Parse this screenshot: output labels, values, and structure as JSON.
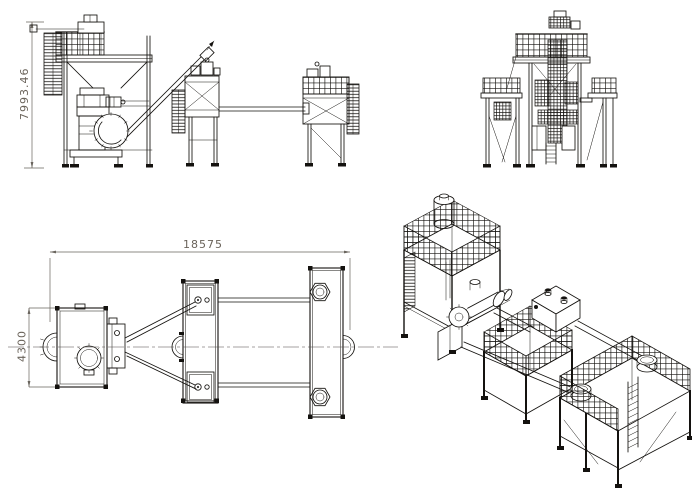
{
  "drawing": {
    "dimensions": {
      "overall_height": {
        "value": "7993.46",
        "orientation": "vertical",
        "view": "front-elevation"
      },
      "overall_length": {
        "value": "18575",
        "orientation": "horizontal",
        "view": "plan"
      },
      "overall_width": {
        "value": "4300",
        "orientation": "vertical",
        "view": "plan"
      }
    },
    "colors": {
      "background": "#ffffff",
      "line": "#14120f",
      "dimension_text": "#6a635a",
      "dimension_line": "#6a655e"
    }
  }
}
